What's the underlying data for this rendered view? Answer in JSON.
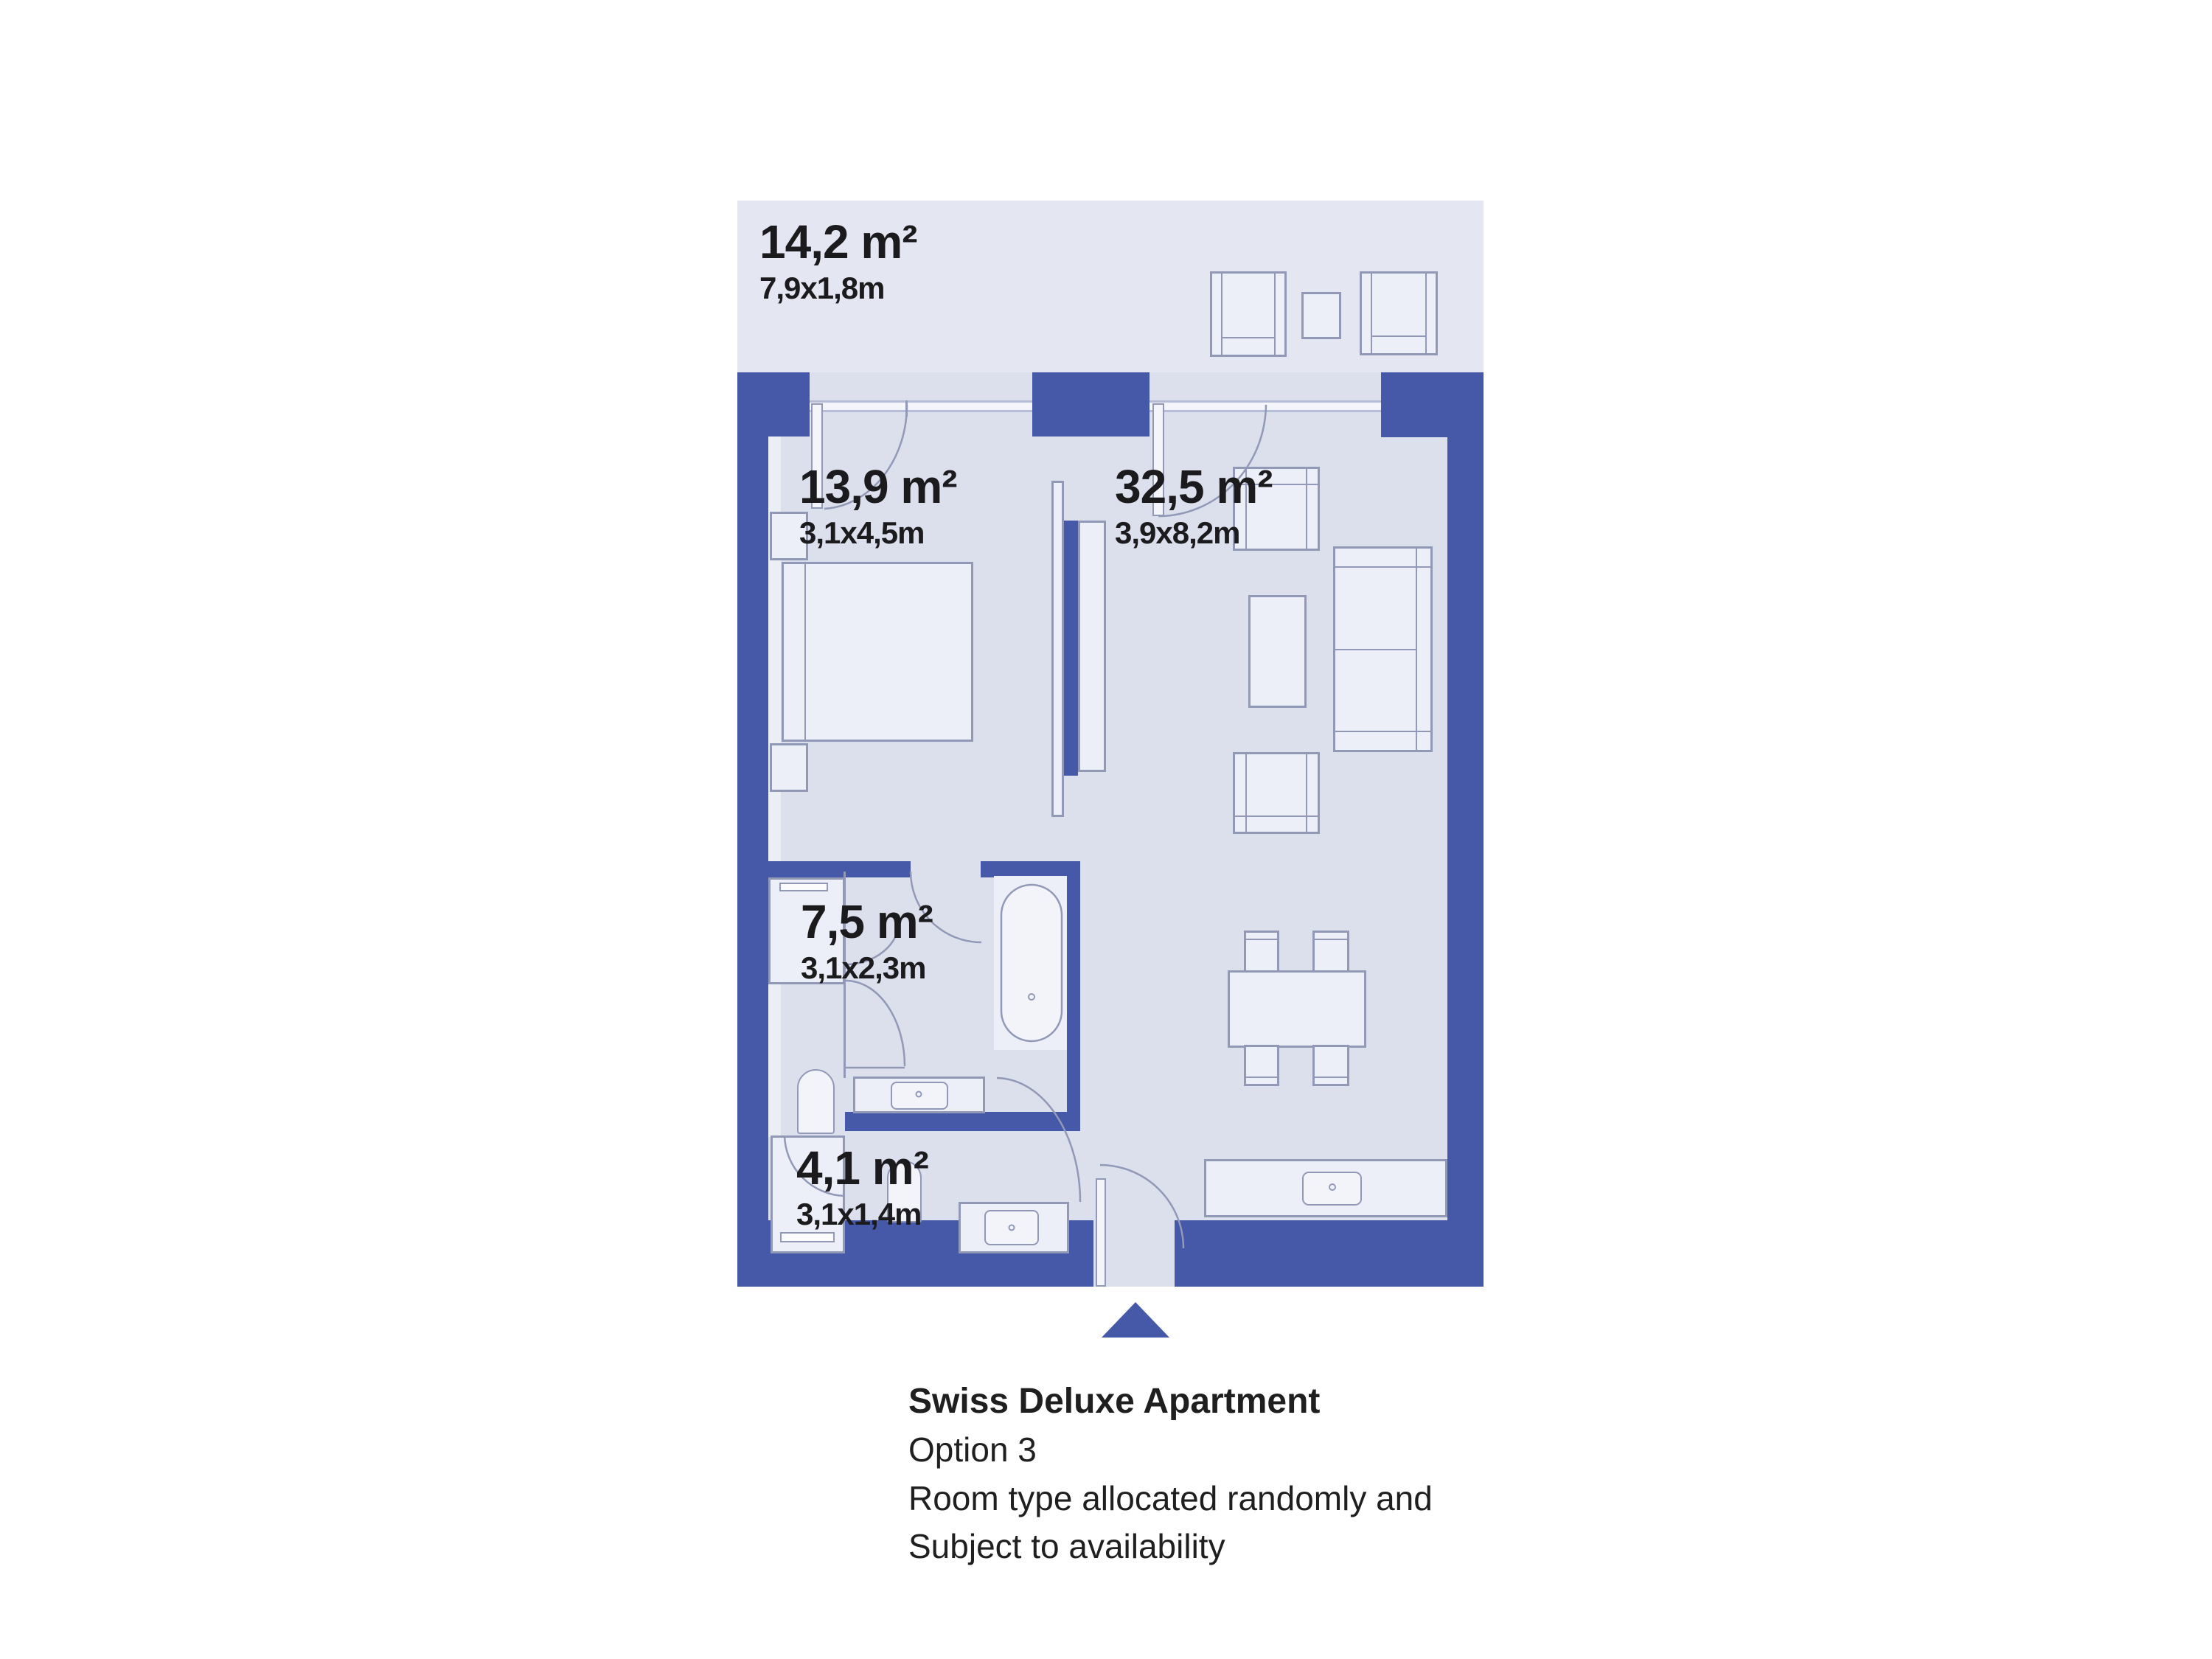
{
  "plan": {
    "type": "apartment-floor-plan",
    "rooms": [
      {
        "id": "balcony",
        "area": "14,2 m²",
        "dims": "7,9x1,8m"
      },
      {
        "id": "bedroom",
        "area": "13,9 m²",
        "dims": "3,1x4,5m"
      },
      {
        "id": "living-room",
        "area": "32,5 m²",
        "dims": "3,9x8,2m"
      },
      {
        "id": "bathroom",
        "area": "7,5 m²",
        "dims": "3,1x2,3m"
      },
      {
        "id": "hallway",
        "area": "4,1 m²",
        "dims": "3,1x1,4m"
      }
    ]
  },
  "caption": {
    "title": "Swiss Deluxe Apartment",
    "line1": "Option 3",
    "line2": "Room type allocated randomly and",
    "line3": "Subject to availability"
  },
  "icons": {
    "entrance_marker": "triangle-up"
  },
  "colors": {
    "wall": "#4659A8",
    "floor": "#DCDFEC",
    "balcony_floor": "#E4E6F1",
    "furniture_fill": "#EDEFF8",
    "outline": "#9199B6",
    "window_line": "#B6BDD6",
    "text": "#1B1B1D",
    "accent": "#4659A8"
  }
}
